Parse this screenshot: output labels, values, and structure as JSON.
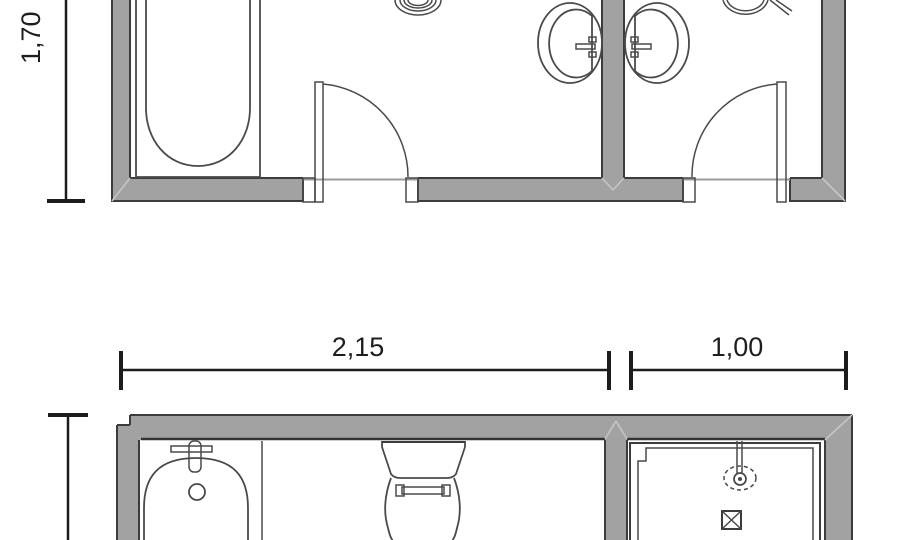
{
  "title": "bathroom floor plans",
  "colors": {
    "wall_fill": "#a2a2a2",
    "wall_outline": "#3c3c3c",
    "fixture_line": "#4a4a4a",
    "dimension_line": "#1c1c1c",
    "dimension_text": "#1e1e1e",
    "miter_highlight": "#c6c6c6",
    "background": "#ffffff"
  },
  "dimensions": {
    "top_plan_height": "1,70",
    "bottom_plan_width_main": "2,15",
    "bottom_plan_width_shower": "1,00"
  },
  "fixtures": {
    "top_plan": [
      "bathtub",
      "basin-partial",
      "washbasin-left",
      "washbasin-right",
      "toilet-partial",
      "door-left",
      "door-right"
    ],
    "bottom_plan": [
      "bidet",
      "toilet",
      "shower-tray",
      "shower-head",
      "shower-drain"
    ]
  }
}
